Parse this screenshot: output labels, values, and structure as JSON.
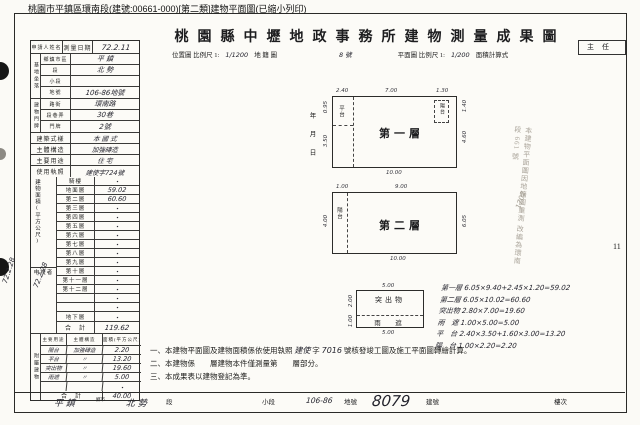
{
  "titlebar": "桃園市平鎮區環南段(建號:00661-000)[第二類]建物平面圖(已縮小列印)",
  "title": "桃園縣中壢地政事務所建物測量成果圖",
  "chief_box": "主任",
  "scale_row": {
    "location_label": "位置圖 比例尺 1:",
    "location_scale": "1/1200",
    "cadastre_label": "地 籍 圖",
    "sheet_no": "8 號",
    "plan_label": "平面圖 比例尺 1:",
    "plan_scale": "1/200",
    "calc_label": "面積計算式"
  },
  "left_table": {
    "applicant_label": "申請人姓名",
    "survey_date_label": "測量日期",
    "survey_date_value": "72.2.11",
    "site_section_label": "基地坐落",
    "site_rows": [
      {
        "label": "鄉鎮市區",
        "value": "平 鎮"
      },
      {
        "label": "段",
        "value": "北 勢"
      },
      {
        "label": "小段",
        "value": ""
      },
      {
        "label": "地號",
        "value": "106-86地號"
      }
    ],
    "door_section_label": "建物門牌",
    "door_rows": [
      {
        "label": "路街",
        "value": "環南路"
      },
      {
        "label": "段巷弄",
        "value": "30巷"
      },
      {
        "label": "門牌",
        "value": "2號"
      }
    ],
    "info_rows": [
      {
        "label": "建築式樣",
        "value": "本 國 式"
      },
      {
        "label": "主體構造",
        "value": "加強磚造"
      },
      {
        "label": "主要用途",
        "value": "住 宅"
      },
      {
        "label": "使用執照",
        "value": "建使字724號"
      }
    ],
    "area_section_label": "建物面積(平方公尺)",
    "floor_rows": [
      {
        "label": "騎樓",
        "value": "・"
      },
      {
        "label": "地面層",
        "value": "59.02"
      },
      {
        "label": "第二層",
        "value": "60.60"
      },
      {
        "label": "第三層",
        "value": "・"
      },
      {
        "label": "第四層",
        "value": "・"
      },
      {
        "label": "第五層",
        "value": "・"
      },
      {
        "label": "第六層",
        "value": "・"
      },
      {
        "label": "第七層",
        "value": "・"
      },
      {
        "label": "第八層",
        "value": "・"
      },
      {
        "label": "第九層",
        "value": "・"
      },
      {
        "label": "第十層",
        "value": "・"
      },
      {
        "label": "第十一層",
        "value": "・"
      },
      {
        "label": "第十二層",
        "value": "・"
      },
      {
        "label": "",
        "value": "・"
      },
      {
        "label": "",
        "value": "・"
      },
      {
        "label": "地下層",
        "value": "・"
      }
    ],
    "total_label": "合　計",
    "total_value": "119.62",
    "reviewer_label": "申複者",
    "reviewer_note": "72.2.28",
    "attached_section_label": "附屬建物",
    "attached_headers": {
      "use": "主要用途",
      "structure": "主體構造",
      "area": "面積(平方公尺)"
    },
    "attached_rows": [
      {
        "use": "陽台",
        "structure": "加強磚造",
        "area": "2.20"
      },
      {
        "use": "平台",
        "structure": "〃",
        "area": "13.20"
      },
      {
        "use": "突出物",
        "structure": "〃",
        "area": "19.60"
      },
      {
        "use": "雨遮",
        "structure": "〃",
        "area": "5.00"
      },
      {
        "use": "",
        "structure": "",
        "area": "・"
      }
    ],
    "attached_total_label": "合　計",
    "attached_total_value": "40.00"
  },
  "date_column": "年月日",
  "plans": {
    "floor1": {
      "name": "第一層",
      "annex": "平台",
      "corner": "陽台",
      "dims": {
        "top": [
          "2.40",
          "7.00",
          "1.30"
        ],
        "bottom": "10.00",
        "left": [
          "0.95",
          "3.50"
        ],
        "right": [
          "1.40",
          "4.60"
        ]
      }
    },
    "floor2": {
      "name": "第二層",
      "annex": "陽台",
      "dims": {
        "top": [
          "1.00",
          "9.00"
        ],
        "bottom": "10.00",
        "left": [
          "4.00"
        ],
        "right": [
          "6.05"
        ]
      }
    },
    "protrusion": {
      "name": "突出物",
      "canopy": "雨　遮",
      "dims": {
        "top": "5.00",
        "bottom": "5.00",
        "left": "2.00",
        "left2": "1.00"
      }
    }
  },
  "calc_lines": [
    "第一層 6.05×9.40+2.45×1.20=59.02",
    "第二層 6.05×10.02=60.60",
    "突出物 2.80×7.00=19.60",
    "雨　遮 1.00×5.00=5.00",
    "平　台 2.40×3.50+1.60×3.00=13.20",
    "陽　台 1.00×2.20=2.20"
  ],
  "notes": {
    "n1_pre": "一、本建物平面圖及建物面積係依使用執照",
    "n1_hand1": "建使",
    "n1_mid": "字",
    "n1_hand2": "7016",
    "n1_post": "號核發竣工圖及施工平面圖轉繪計算。",
    "n2": "二、本建物係　　層建物本件僅測量第　　層部分。",
    "n3": "三、本成果表以建物登記為準。"
  },
  "stamp": {
    "line1": "本建物平面圖因地籍圖重測",
    "line2": "改編為環南段 661 號",
    "extra": "1702"
  },
  "page_no": "11",
  "margin_note": "72.2.28",
  "footer": {
    "township_value": "平 鎮",
    "township_label": "鄉市",
    "section_value": "北 勢",
    "section_label": "段",
    "subsection_label": "小段",
    "parcel_value": "106-86",
    "parcel_label": "地號",
    "building_value": "8079",
    "building_label": "建號",
    "floor_label": "樓次"
  }
}
